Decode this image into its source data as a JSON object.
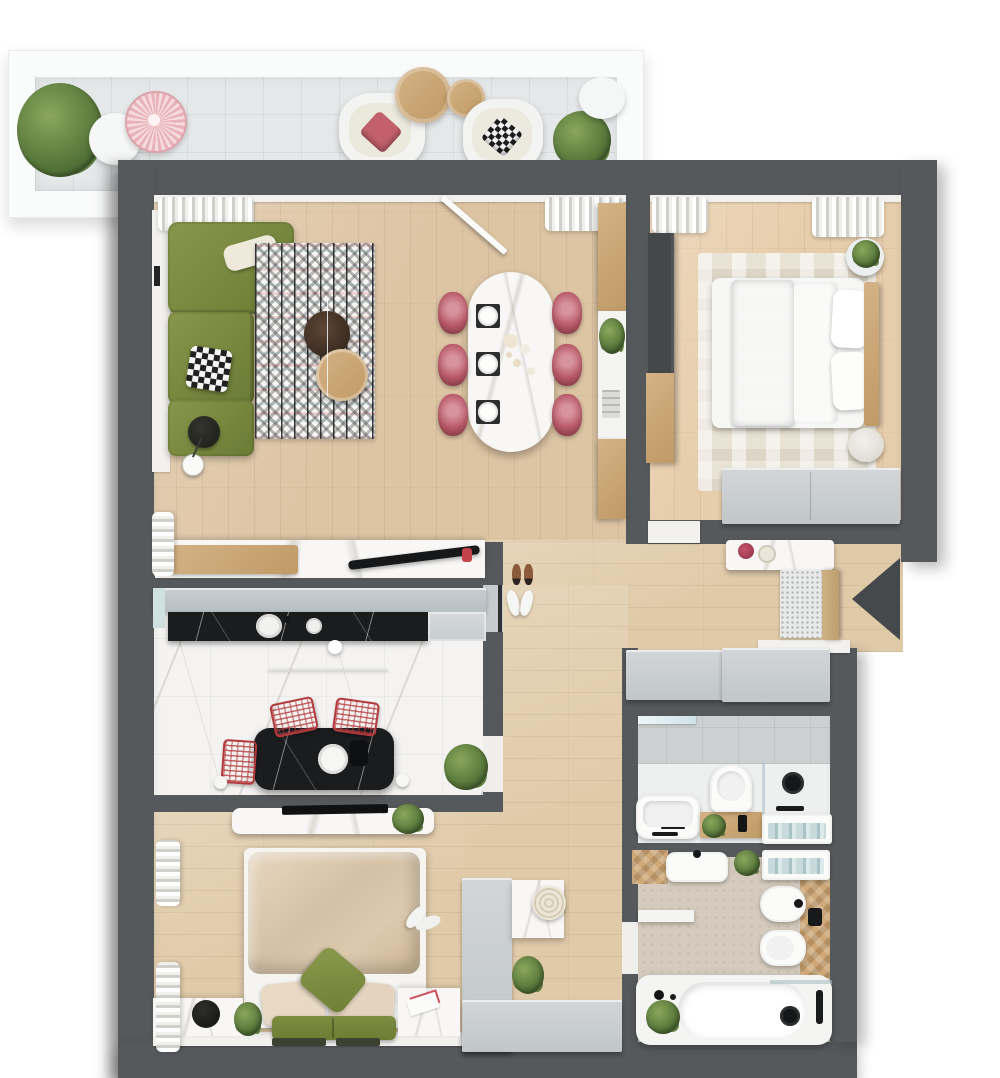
{
  "title": "Apartment floor plan – rendered top view",
  "entrance": {
    "label": "Entrance",
    "symbol": "left-arrow"
  },
  "palette": {
    "wall": "#56595c",
    "wood_floor": "#ddc5a4",
    "balcony_tile": "#e5e8e9",
    "kitchen_marble": "#f4f3f1",
    "black_marble": "#1b1c1e",
    "sofa_green": "#7b8b41",
    "textile_green": "#7d9144",
    "rose_chair": "#bb5c6b",
    "red_wire_chair": "#b23a3e",
    "duvet_beige": "#d9c6ac",
    "cabinet_gray": "#c6cbcd",
    "dresser_gray": "#b6bcc0",
    "towel_teal": "#b8cfd2",
    "plant_green": "#5d7d3a",
    "wood_furniture": "#c9a876",
    "bath_concrete": "#d4cabd"
  },
  "rooms": [
    {
      "id": "balcony",
      "label": "Balcony",
      "furniture": [
        "potted plant",
        "white side table",
        "pink wire coffee table",
        "lounge chair with pink pillow",
        "round wooden coffee tables",
        "lounge chair with patterned pillow",
        "potted plant",
        "white side table"
      ]
    },
    {
      "id": "living-room",
      "label": "Living and dining room",
      "furniture": [
        "green corner sofa",
        "white pillow",
        "patterned pillow",
        "floor lamp",
        "zigzag rug",
        "dark round coffee table",
        "wooden round coffee table",
        "oval marble dining table",
        "six rose dining chairs",
        "tableware",
        "wall shelf with plant",
        "desk with wooden board",
        "black wall shelf",
        "curtains",
        "open balcony door"
      ]
    },
    {
      "id": "bedroom-1",
      "label": "Bedroom with double bed",
      "furniture": [
        "double bed",
        "green runner blanket",
        "pillows",
        "wooden headboard",
        "area rug",
        "round side table with plant",
        "pouf",
        "gray dresser",
        "dark wardrobe",
        "wooden cabinet",
        "curtains"
      ]
    },
    {
      "id": "kitchen",
      "label": "Kitchen",
      "furniture": [
        "upper cabinet row",
        "black marble countertop",
        "round sink",
        "gray counter",
        "black marble island",
        "three red wire chairs",
        "pendant lights",
        "plant"
      ]
    },
    {
      "id": "bedroom-2",
      "label": "Second bedroom",
      "furniture": [
        "bed with beige duvet",
        "green accent pillow",
        "beige pillows",
        "green bench",
        "marble TV console",
        "TV",
        "marble nightstand",
        "black decor disc",
        "plants",
        "slippers",
        "curtains"
      ]
    },
    {
      "id": "hallway",
      "label": "Entrance hallway",
      "furniture": [
        "marble console with flowers",
        "doormat",
        "wooden entrance door",
        "gray wardrobes",
        "white bench shelf"
      ]
    },
    {
      "id": "corridor",
      "label": "Corridor and dressing area",
      "furniture": [
        "shoes",
        "slippers",
        "L-shaped white wardrobe",
        "marble vanity",
        "round basket",
        "plant"
      ]
    },
    {
      "id": "wc",
      "label": "Shower room",
      "furniture": [
        "washbasin",
        "black faucet",
        "toilet",
        "shower with black fixture",
        "glass screen",
        "wooden counter with plant",
        "towel niche",
        "mirror"
      ]
    },
    {
      "id": "bathroom",
      "label": "Bathroom",
      "furniture": [
        "washbasin",
        "bidet",
        "toilet",
        "bathtub",
        "black bath faucet",
        "towel niche",
        "plants",
        "wooden accent wall"
      ]
    }
  ]
}
